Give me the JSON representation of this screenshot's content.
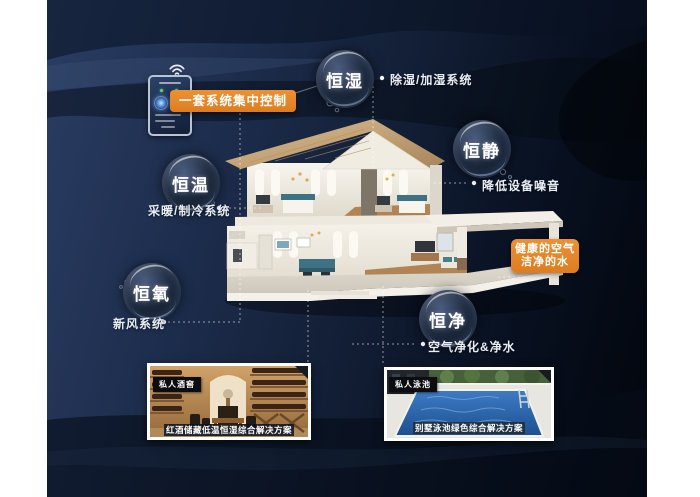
{
  "bubbles": [
    {
      "label": "恒湿",
      "desc": "除湿/加湿系统"
    },
    {
      "label": "恒静",
      "desc": "降低设备噪音"
    },
    {
      "label": "恒温",
      "desc": "采暖/制冷系统"
    },
    {
      "label": "恒氧",
      "desc": "新风系统"
    },
    {
      "label": "恒净",
      "desc": "空气净化&净水"
    }
  ],
  "badges": {
    "control": "一套系统集中控制",
    "healthy_line1": "健康的空气",
    "healthy_line2": "洁净的水"
  },
  "photos": [
    {
      "tag": "私人酒窖",
      "caption": "红酒储藏低温恒湿综合解决方案"
    },
    {
      "tag": "私人泳池",
      "caption": "别墅泳池绿色综合解决方案"
    }
  ],
  "icons": {
    "wifi": "wifi-icon"
  },
  "colors": {
    "accent_orange": "#E5862C",
    "bg_navy": "#1D2D4D",
    "bubble_dark": "#0C1524"
  }
}
